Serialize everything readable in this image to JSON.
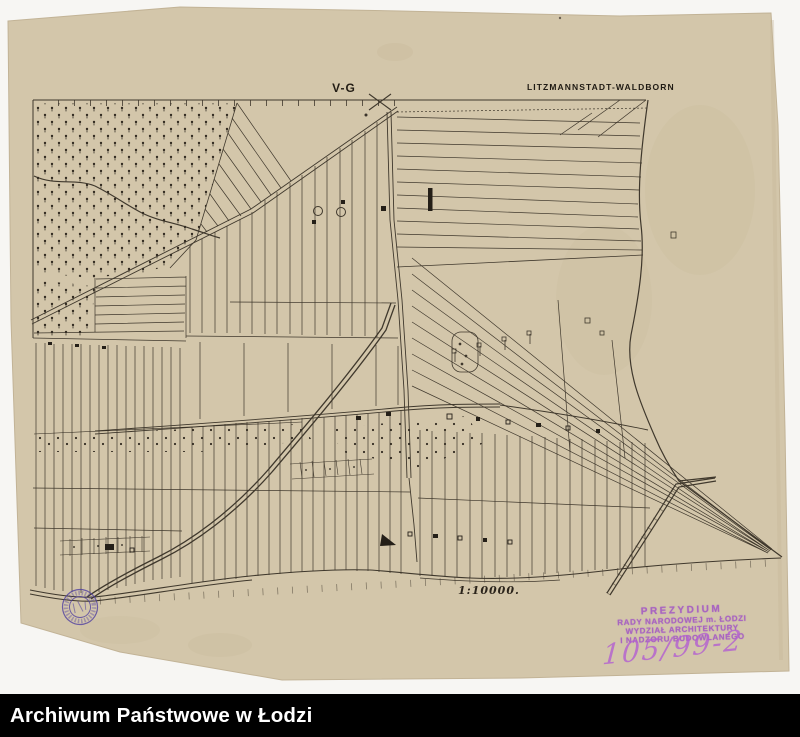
{
  "scan": {
    "background_color": "#f7f6f3",
    "paper_color": "#d3c6aa",
    "ink_color": "#332c22"
  },
  "map": {
    "sheet_code": "V-G",
    "title": "LITZMANNSTADT-WALDBORN",
    "scale_label": "1:10000."
  },
  "stamps": {
    "office": {
      "color": "#a358c4",
      "line1": "PREZYDIUM",
      "line2": "RADY NARODOWEJ m. ŁODZI",
      "line3": "WYDZIAŁ ARCHITEKTURY",
      "line4": "I NADZORU BUDOWLANEGO"
    },
    "reference_number": "105/99-2",
    "round_seal_color": "#4d3da0"
  },
  "footer": {
    "label": "Archiwum Państwowe w Łodzi",
    "background": "#000000",
    "text_color": "#ffffff"
  }
}
